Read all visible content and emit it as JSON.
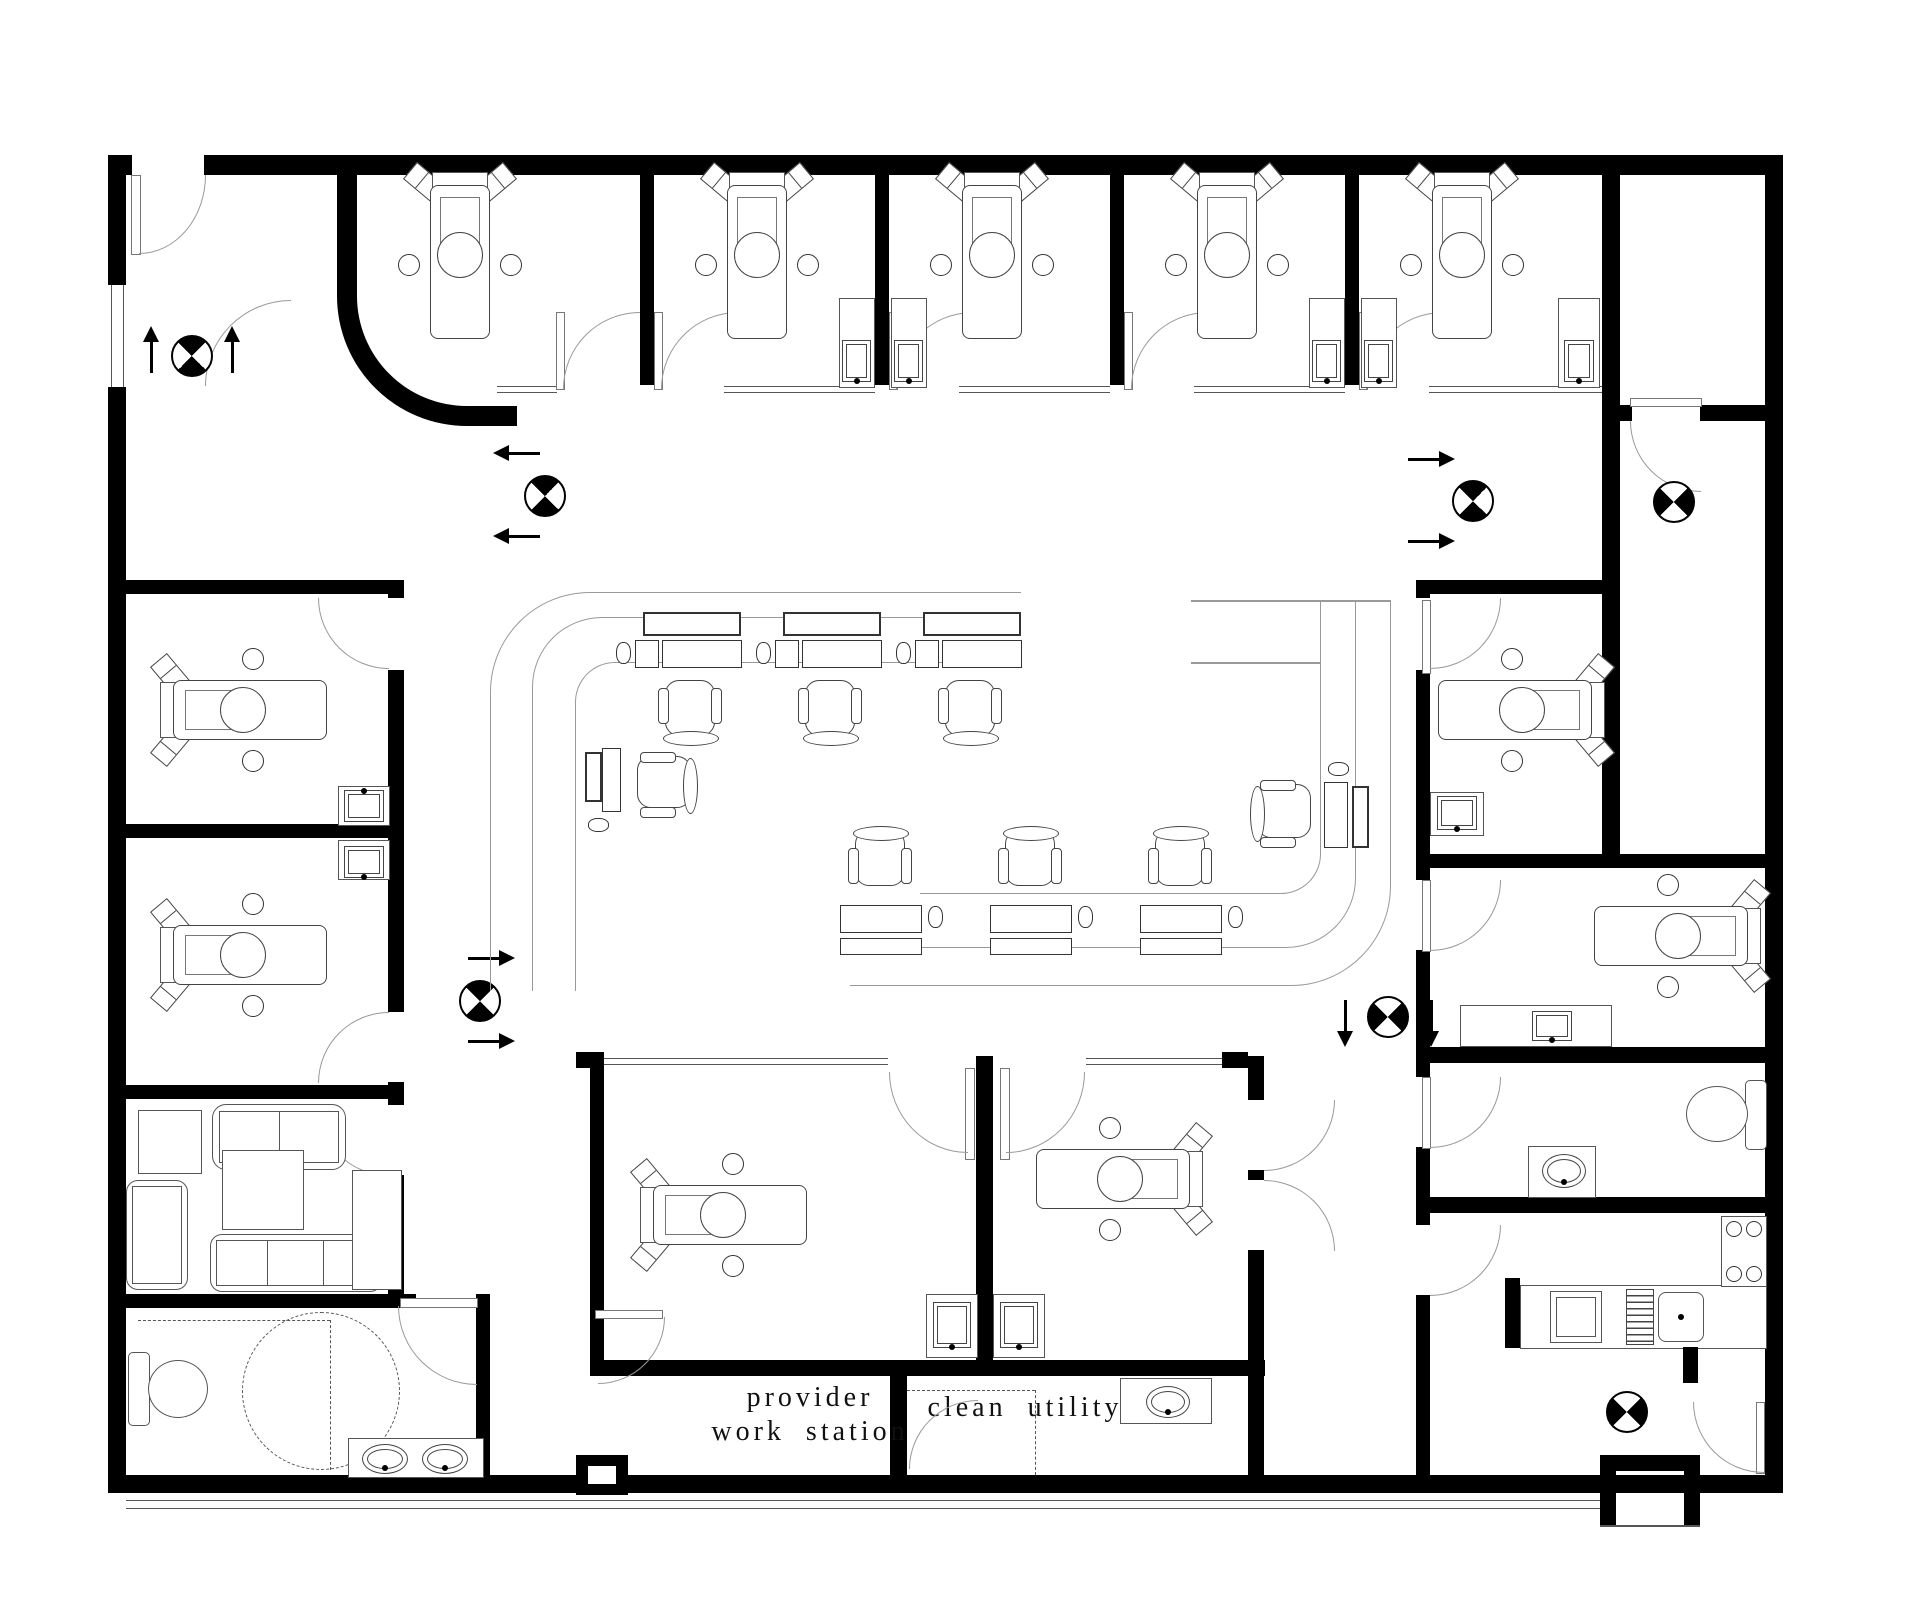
{
  "labels": {
    "provider_line1": "provider",
    "provider_line2": "work station",
    "clean_utility": "clean utility"
  },
  "colors": {
    "walls": "#000000",
    "furniture_outline": "#555555",
    "background": "#ffffff"
  }
}
